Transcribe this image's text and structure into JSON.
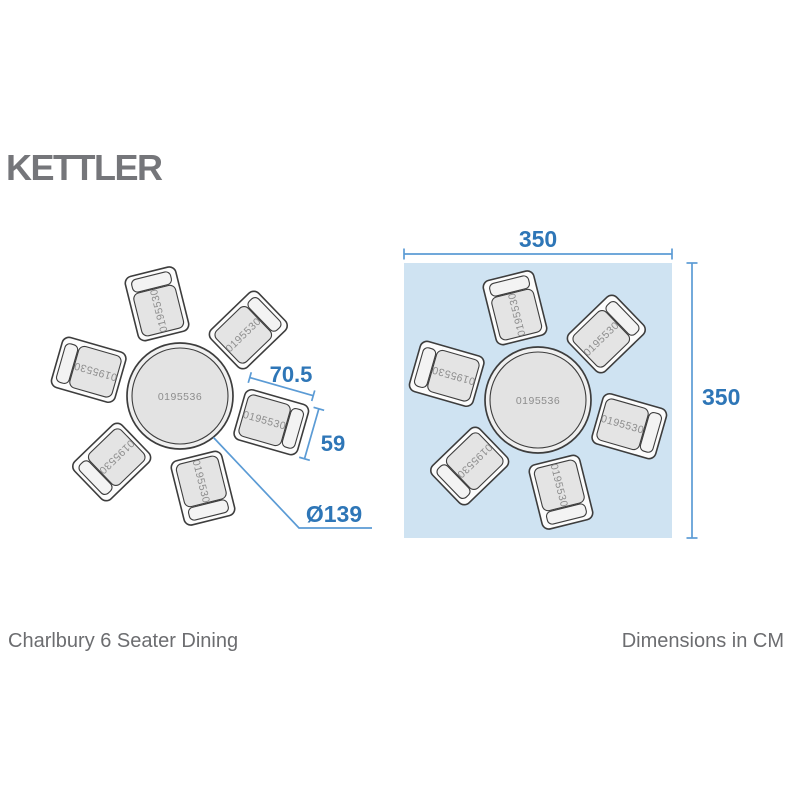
{
  "brand": {
    "logo": "KETTLER"
  },
  "product": {
    "title": "Charlbury 6 Seater Dining",
    "table_sku": "0195536",
    "chair_sku": "0195530"
  },
  "annotations": {
    "chair_width_cm": "70.5",
    "chair_depth_cm": "59",
    "table_diameter_cm": "Ø139",
    "footprint_width_cm": "350",
    "footprint_height_cm": "350",
    "units_label": "Dimensions in CM"
  },
  "colors": {
    "accent_text": "#2e76b7",
    "accent_line": "#5b9bd5",
    "footprint_fill": "#cfe3f2",
    "logo_gray": "#75767a",
    "caption_gray": "#6c6d70",
    "outline_dark": "#3d3d3d",
    "sku_gray": "#8d8d8d"
  }
}
